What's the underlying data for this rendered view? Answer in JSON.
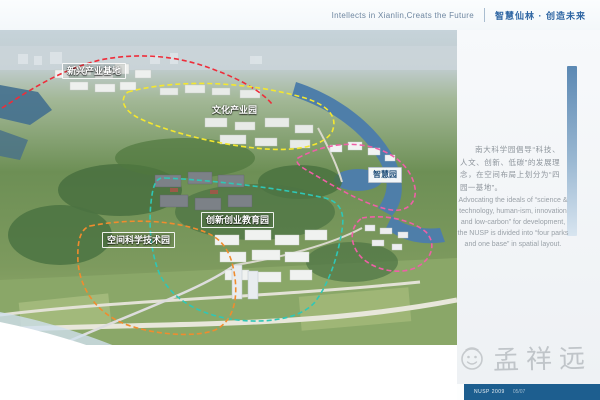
{
  "header": {
    "title_en": "Intellects in Xianlin,Creats the Future",
    "title_zh": "智慧仙林 · 创造未来",
    "accent_color": "#2f66a3"
  },
  "map": {
    "description": "aerial-rendering-of-science-park-with-dashed-zone-outlines",
    "zones": [
      {
        "id": "emerging-industry-base",
        "label": "新兴产业基地",
        "outline_color": "#ee2d3a"
      },
      {
        "id": "culture-industry-park",
        "label": "文化产业园",
        "outline_color": "#f4e72f"
      },
      {
        "id": "smart-park",
        "label": "智慧园",
        "outline_color": "#ef5fa7"
      },
      {
        "id": "innovation-education-park",
        "label": "创新创业教育园",
        "outline_color": "#2fc7b6"
      },
      {
        "id": "space-science-park",
        "label": "空间科学技术园",
        "outline_color": "#f08c2e"
      }
    ]
  },
  "sidebar": {
    "paragraph_zh": "南大科学园倡导“科技、人文、创新、低碳”的发展理念，在空间布局上划分为“四园一基地”。",
    "paragraph_en": "Advocating the ideals of “science & technology, human-ism, innovation and low-carbon” for development, the NUSP is divided into “four parks and one base” in spatial layout.",
    "text_color": "#8e959c"
  },
  "watermark": {
    "name": "孟祥远",
    "icon": "smiley-face-icon",
    "color": "#c0c5c9"
  },
  "footer": {
    "left_text": "NUSP 2009",
    "page_text": "05/07",
    "bar_color": "#1d5e8f"
  }
}
